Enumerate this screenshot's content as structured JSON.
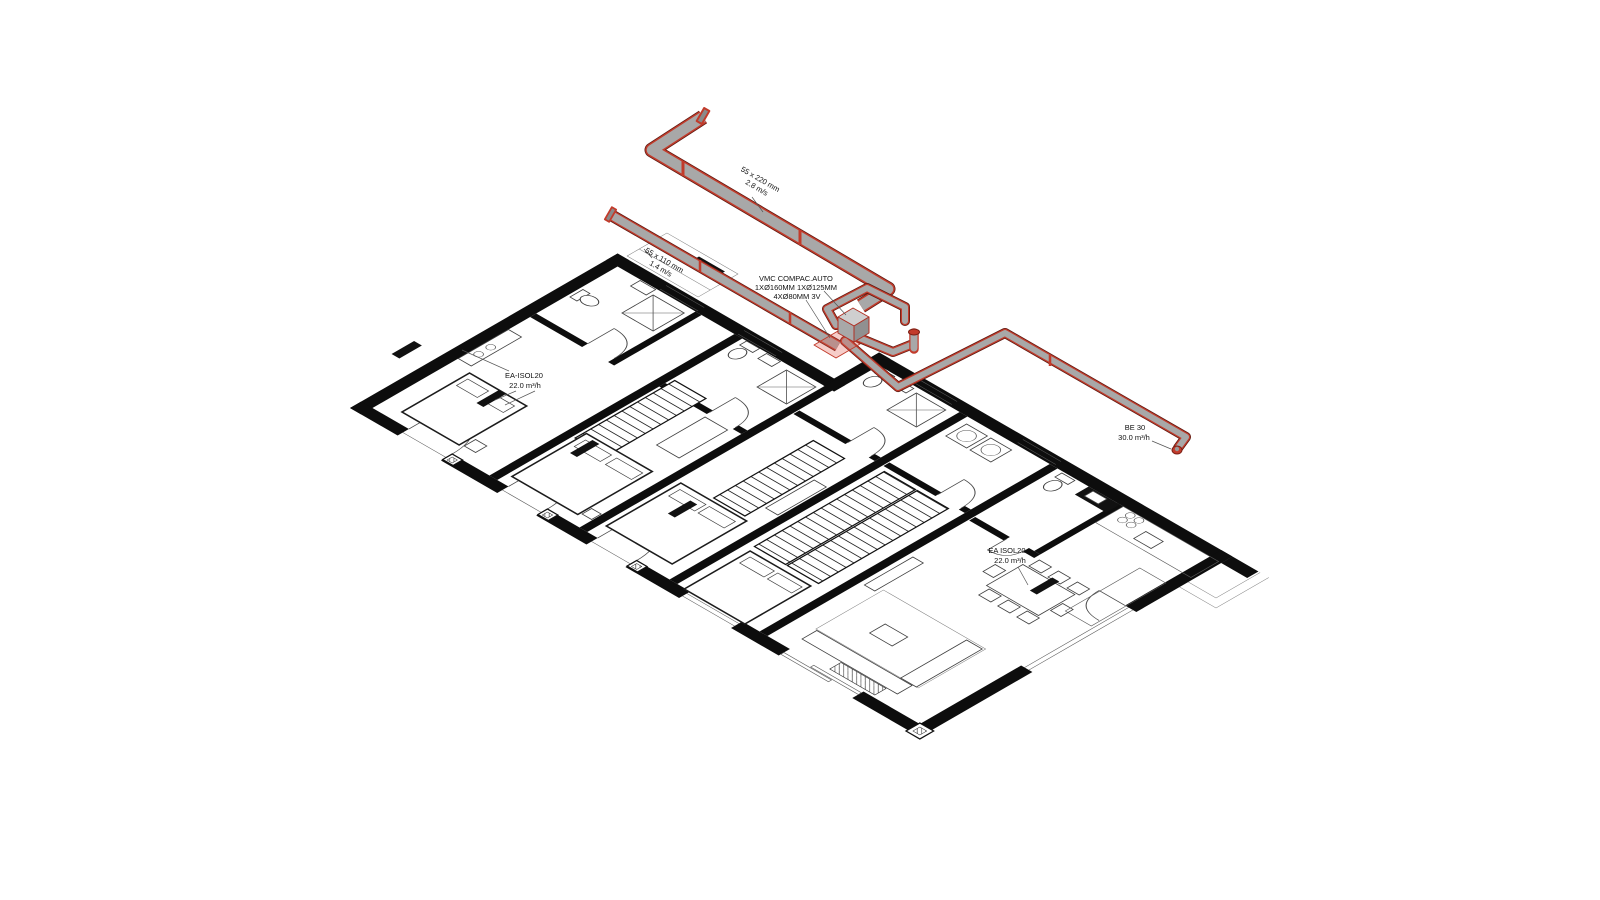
{
  "drawing": {
    "type": "isometric HVAC ventilation plan over architectural floor plan",
    "colors": {
      "duct_red": "#c23b2b",
      "duct_dark_red": "#5c1a12",
      "duct_gray": "#a8a8a8",
      "wall_black": "#0d0d0d",
      "plenum_pink": "rgba(226,88,76,0.3)",
      "background": "#ffffff"
    },
    "labels": {
      "duct_main": {
        "line1": "55 x 220 mm",
        "line2": "2.8 m/s"
      },
      "duct_branch": {
        "line1": "55 x 110 mm",
        "line2": "1.4 m/s"
      },
      "vmc_unit": {
        "line1": "VMC COMPAC.AUTO",
        "line2": "1XØ160MM 1XØ125MM",
        "line3": "4XØ80MM 3V"
      },
      "extract_left": {
        "line1": "EA-ISOL20",
        "line2": "22.0 m³/h"
      },
      "extract_right": {
        "line1": "EA ISOL20",
        "line2": "22.0 m³/h"
      },
      "outlet": {
        "line1": "BE 30",
        "line2": "30.0 m³/h"
      }
    }
  }
}
